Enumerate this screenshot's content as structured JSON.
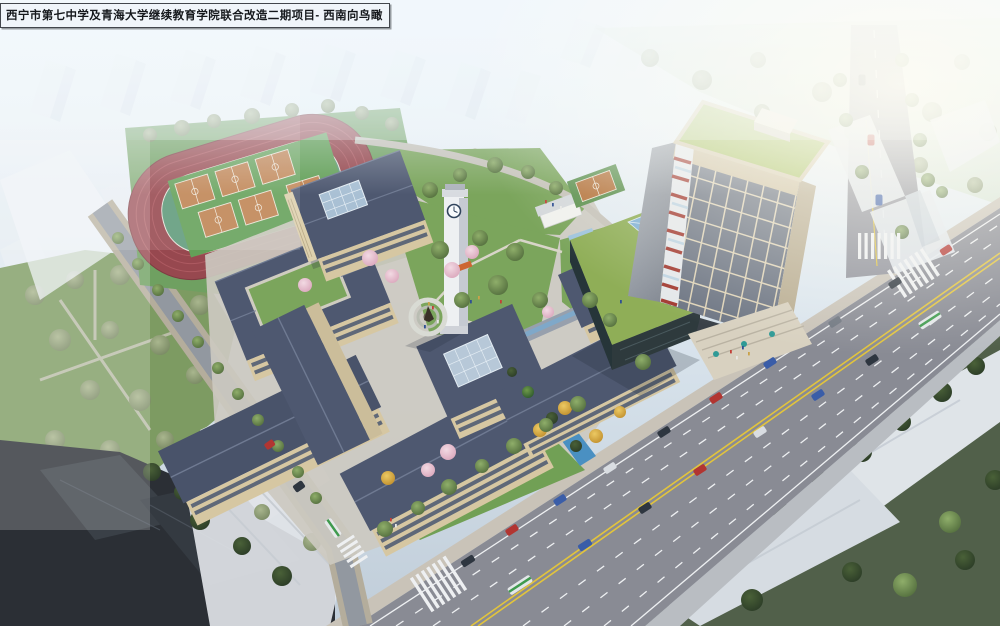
{
  "caption": {
    "title": "西宁市第七中学及青海大学继续教育学院联合改造二期项目- 西南向鸟瞰"
  },
  "scene": {
    "type": "architectural-aerial-rendering",
    "view_direction": "southwest bird's-eye view",
    "site": {
      "running_tracks": 1,
      "basketball_courts_infield": 6,
      "basketball_courts_standalone": 1,
      "clock_towers": 1,
      "highrise_towers": 1,
      "statue_plazas": 1,
      "water_channels": 1
    },
    "colors": {
      "sky_haze": "#eef4f9",
      "track": "#97484f",
      "track_infield": "#5f9a7a",
      "basketball_court": "#bf8352",
      "court_apron": "#63a058",
      "campus_roof": "#4e5870",
      "campus_wall": "#d6c7a2",
      "lawn": "#7ba55c",
      "tower_facade": "#6e7684",
      "tower_lattice": "#ded3b8",
      "tower_green_roof": "#a9c161",
      "tower_accent_red": "#a23a31",
      "podium_glass": "#2e3a3d",
      "skylight_blue": "#7fb0d4",
      "road": "#898b94",
      "marking_yellow": "#e2c43c",
      "marking_white": "#eef0f2",
      "water": "#4a90c2",
      "tree_green": "#55703f",
      "tree_dark": "#2c3d27",
      "tree_pink": "#dba8bd",
      "tree_autumn": "#c2912f",
      "haze_building": "#e9eef3",
      "dark_block": "#2b2f35",
      "caption_bg": "#f0f5fa",
      "caption_border": "#42464c",
      "caption_text": "#15181c"
    }
  }
}
